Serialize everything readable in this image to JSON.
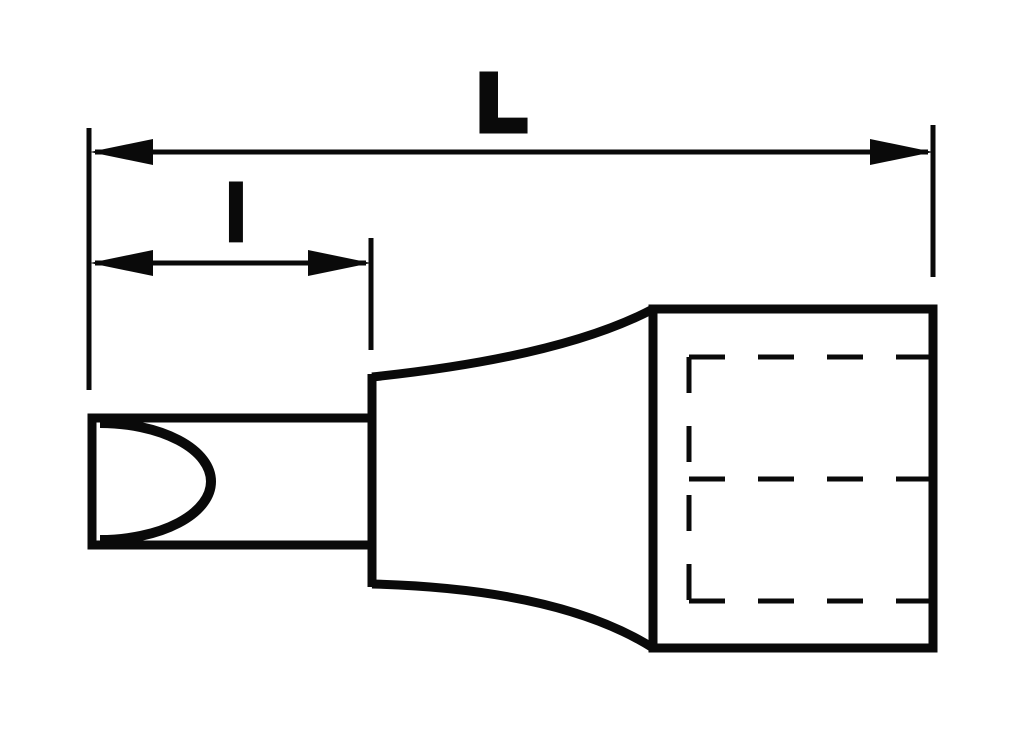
{
  "figure": {
    "name": "slotted-bit-socket-technical-drawing",
    "background": "#ffffff",
    "line_color": "#0a0a0a"
  },
  "dimensions": {
    "overall_length": {
      "label": "L"
    },
    "tip_length": {
      "label": "l"
    }
  }
}
